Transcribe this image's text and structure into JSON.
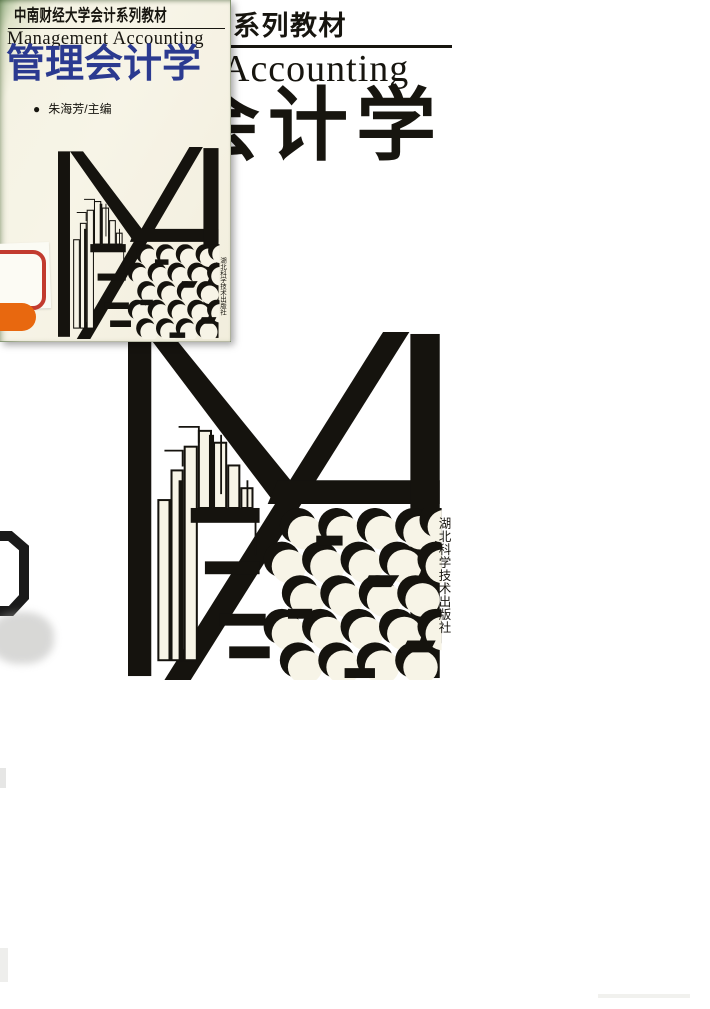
{
  "page": {
    "background": "#ffffff"
  },
  "colors": {
    "page_bg": "#ffffff",
    "ink": "#17150f",
    "title_blue": "#2b3a90",
    "logo_ink": "#15130e",
    "red_sticker": "#c23b2f",
    "orange_sticker": "#e8680f",
    "cover_cream": "#f7f4e7",
    "cover_green": "#9fb88f"
  },
  "small_cover": {
    "series_label": "中南财经大学会计系列教材",
    "subtitle_en": "Management Accounting",
    "title": "管理会计学",
    "editor_bullet": "●",
    "editor_name": "朱海芳/主编",
    "publisher_vertical": "湖北科学技术出版社"
  },
  "large_cover": {
    "series_label_visible": "系列教材",
    "subtitle_en_visible": "Accounting",
    "title_visible": "会计学",
    "publisher_vertical": "湖北科学技术出版社"
  },
  "icons": {
    "logo": "ma-monogram-logo"
  }
}
